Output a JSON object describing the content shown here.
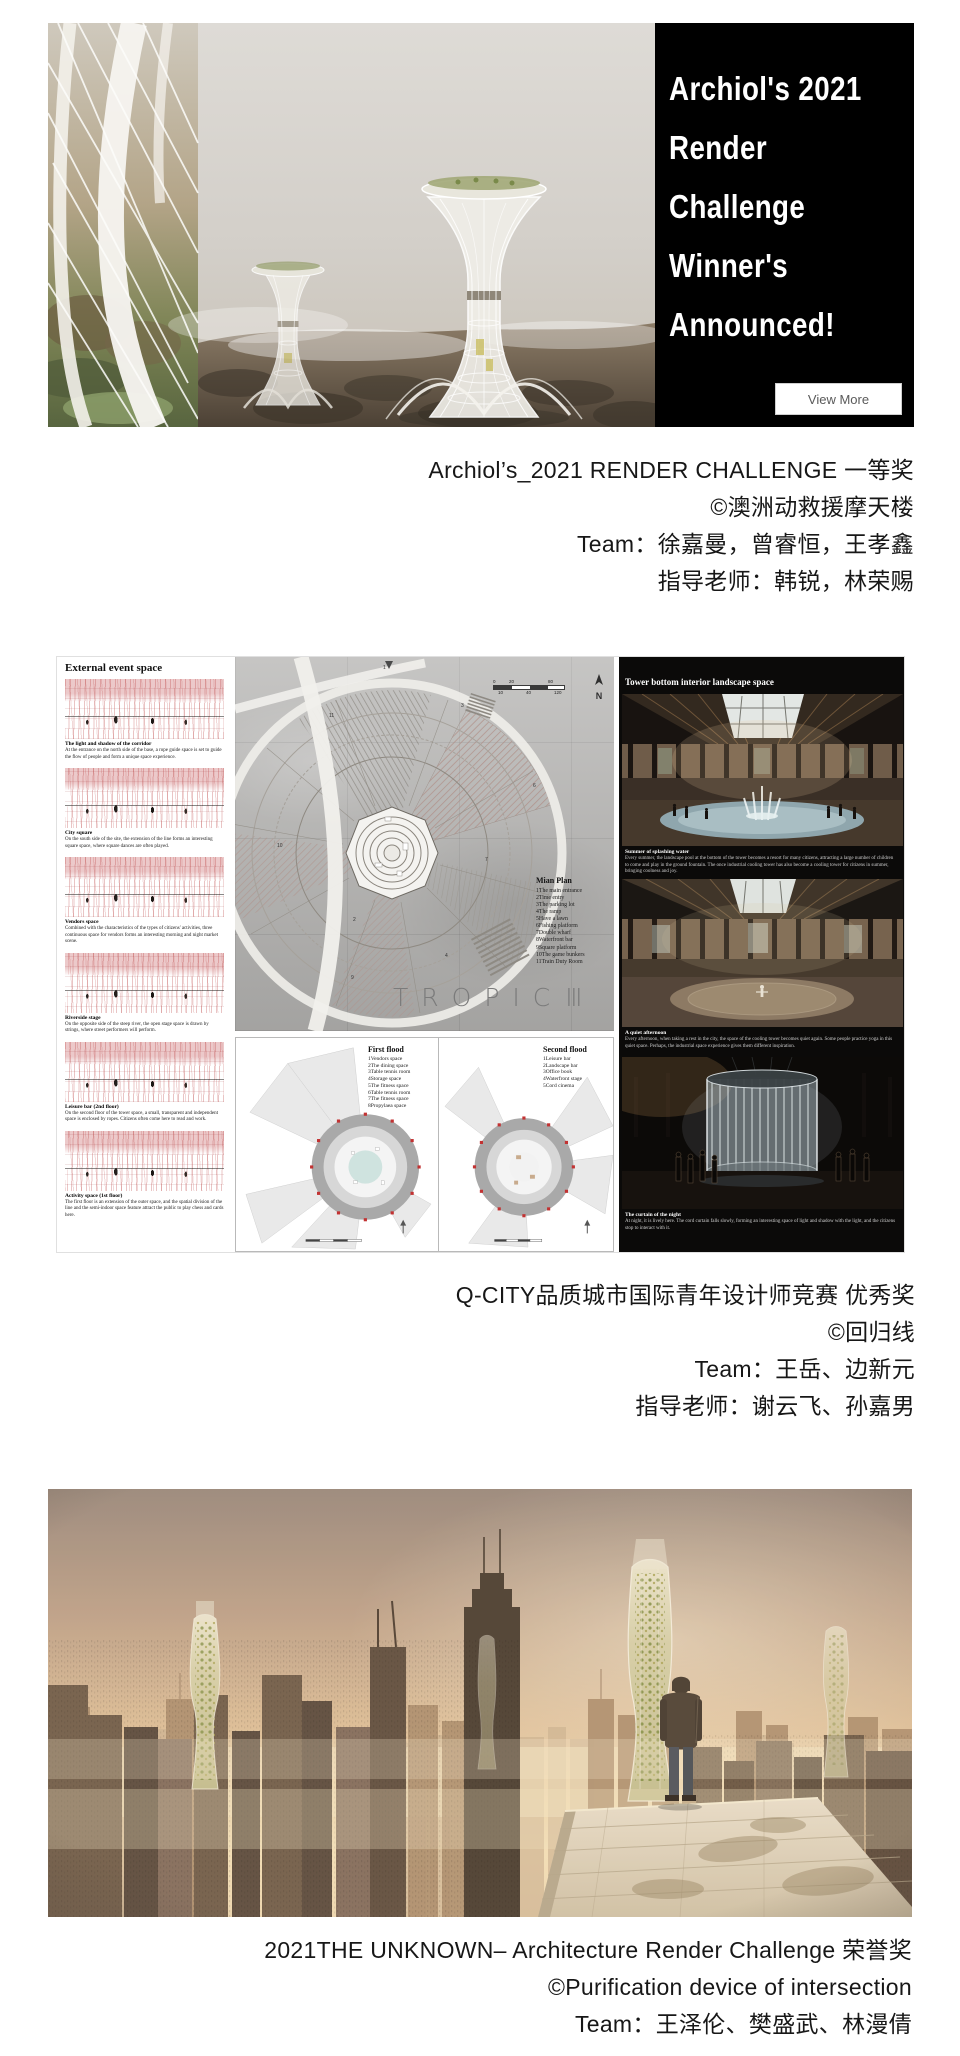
{
  "banner": {
    "panel_bg": "#000000",
    "heading_lines": [
      "Archiol's 2021",
      "Render",
      "Challenge",
      "Winner's",
      "Announced!"
    ],
    "button_label": "View More"
  },
  "captions": {
    "first": {
      "line1": "Archiol’s_2021 RENDER CHALLENGE 一等奖",
      "line2": "©澳洲动救援摩天楼",
      "line3": "Team：徐嘉曼，曾睿恒，王孝鑫",
      "line4": "指导老师：韩锐，林荣赐"
    },
    "second": {
      "line1": "Q-CITY品质城市国际青年设计师竞赛 优秀奖",
      "line2": "©回归线",
      "line3": "Team：王岳、边新元",
      "line4": "指导老师：谢云飞、孙嘉男"
    },
    "third": {
      "line1": "2021THE UNKNOWN– Architecture Render Challenge 荣誉奖",
      "line2": "©Purification device of intersection",
      "line3": "Team：王泽伦、樊盛武、林漫倩"
    }
  },
  "poster": {
    "left": {
      "header": "External event space",
      "items": [
        {
          "title": "The light and shadow of the corridor",
          "text": "At the entrance on the north side of the base, a rope guide space is set to guide the flow of people and form a unique space experience."
        },
        {
          "title": "City square",
          "text": "On the south side of the site, the extension of the line forms an interesting square space, where square dances are often played."
        },
        {
          "title": "Vendors space",
          "text": "Combined with the characteristics of the types of citizens' activities, three continuous space for vendors forms an interesting morning and night market scene."
        },
        {
          "title": "Riverside stage",
          "text": "On the opposite side of the steep river, the open stage space is drawn by strings, where street performers will perform."
        },
        {
          "title": "Leisure bar (2nd floor)",
          "text": "On the second floor of the tower space, a small, transparent and independent space is enclosed by ropes. Citizens often come here to read and work."
        },
        {
          "title": "Activity space (1st floor)",
          "text": "The first floor is an extension of the outer space, and the spatial division of the line and the semi-indoor space feature attract the public to play chess and cards here."
        }
      ]
    },
    "plan": {
      "north_label": "N",
      "scale_top": [
        "0",
        "20",
        "80"
      ],
      "scale_bottom": [
        "10",
        "40",
        "120"
      ],
      "legend_title": "Mian Plan",
      "legend_items": [
        "1The main entrance",
        "2Time entry",
        "3The parking lot",
        "4The ramp",
        "5Have a lawn",
        "6Fishing platform",
        "7Double wharf",
        "8Waterfront bar",
        "9Square platform",
        "10The game bunkers",
        "11Train Duty Room"
      ],
      "marks": [
        "1",
        "2",
        "3",
        "4",
        "6",
        "7",
        "9",
        "10",
        "11"
      ],
      "tropic_text": "TROPIC",
      "tropic_numeral": "Ⅲ"
    },
    "floors": {
      "first_title": "First flood",
      "first_items": [
        "1Vendors space",
        "2The dining space",
        "3Table tennis room",
        "4Storage space",
        "5The fitness space",
        "6Table tennis room",
        "7The fitness space",
        "8Propylaea space"
      ],
      "second_title": "Second flood",
      "second_items": [
        "1Leisure bar",
        "2Landscape bar",
        "3Office book",
        "4Waterfront stage",
        "5Cord cinema"
      ]
    },
    "right": {
      "header": "Tower bottom interior landscape space",
      "items": [
        {
          "title": "Summer of splashing water",
          "text": "Every summer, the landscape pool at the bottom of the tower becomes a resort for many citizens, attracting a large number of children to come and play in the ground fountain. The once industrial cooling tower has also become a cooling tower for citizens in summer, bringing coolness and joy."
        },
        {
          "title": "A quiet afternoon",
          "text": "Every afternoon, when taking a rest in the city, the space of the cooling tower becomes quiet again. Some people practice yoga in this quiet space. Perhaps, the industrial space experience gives them different inspiration."
        },
        {
          "title": "The curtain of the night",
          "text": "At night, it is lively here. The cord curtain falls slowly, forming an interesting space of light and shadow with the light, and the citizens stop to interact with it."
        }
      ]
    }
  },
  "colors": {
    "panel_black": "#0b0a09",
    "concrete": "#b6b5b3",
    "sketch_red": "#bb3e40"
  }
}
